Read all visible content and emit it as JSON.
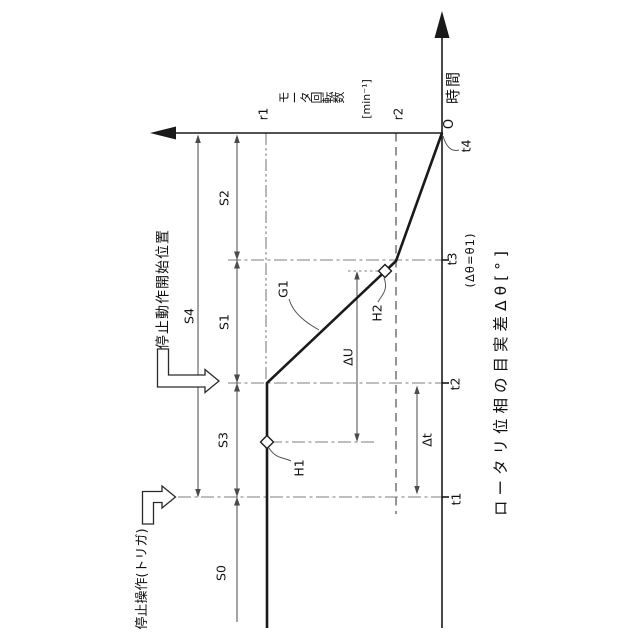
{
  "axes": {
    "time": {
      "label": "時間",
      "origin": "O",
      "ticks": [
        "t1",
        "t2",
        "t3",
        "t4"
      ]
    },
    "speed": {
      "label": "モータ回転数",
      "unit": "[min⁻¹]",
      "levels": [
        "r1",
        "r2"
      ]
    },
    "phase": {
      "label": "ロータリ位相の目実差Δθ[°]",
      "t3_note": "(Δθ=θ1)"
    }
  },
  "segments": {
    "s0": "S0",
    "s1": "S1",
    "s2": "S2",
    "s3": "S3",
    "s4": "S4"
  },
  "markers": {
    "g1": "G1",
    "h1": "H1",
    "h2": "H2"
  },
  "deltas": {
    "du": "ΔU",
    "dt": "Δt"
  },
  "annotations": {
    "stop_start": "停止動作開始位置",
    "trigger": "停止操作(トリガ)"
  },
  "chart_data": {
    "type": "line",
    "title": "モータ回転数の停止動作プロファイル (rotated 90° CCW patent figure)",
    "xlabel": "時間",
    "ylabel": "モータ回転数 [min⁻¹]",
    "x_ticks": [
      "t1",
      "t2",
      "t3",
      "t4"
    ],
    "y_levels": [
      "0",
      "r2",
      "r1"
    ],
    "series": [
      {
        "name": "モータ回転数",
        "points": [
          [
            "start",
            "r1"
          ],
          [
            "t1",
            "r1"
          ],
          [
            "t2",
            "r1"
          ],
          [
            "t3",
            "r2"
          ],
          [
            "t4",
            "0"
          ]
        ]
      }
    ],
    "annotations": [
      "S0: before t1",
      "S3: t1→t2",
      "S1: t2→t3",
      "S2: t3→t4",
      "S4: t1→t4",
      "H1 on r1 plateau at level line",
      "H2 on decel segment between t2 and t3",
      "ΔU between H2 and H1 levels",
      "Δt between t1 and t2",
      "t3 condition: Δθ=θ1",
      "trigger at t1",
      "stop action starts at t2"
    ],
    "legend_position": "none",
    "grid": false
  }
}
